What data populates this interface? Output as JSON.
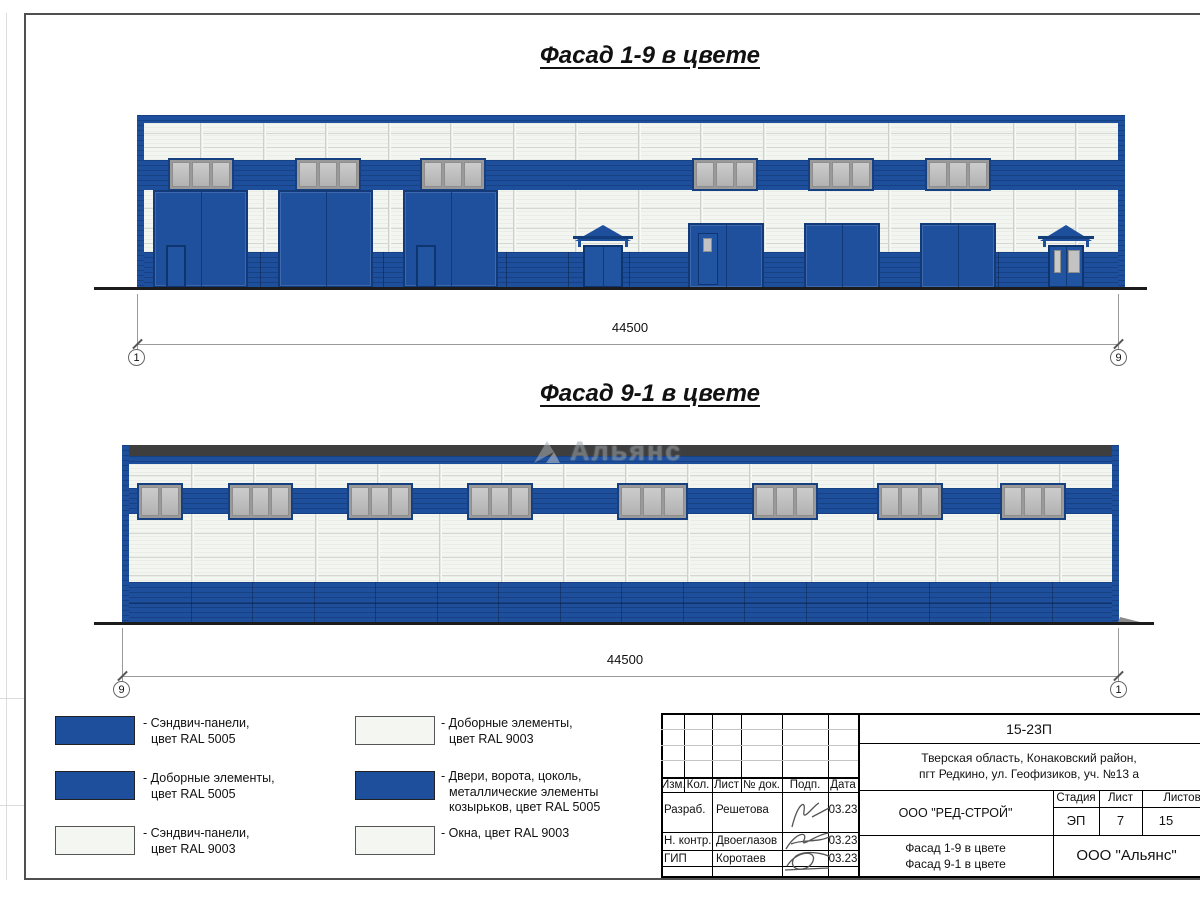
{
  "titles": {
    "facade19": "Фасад 1-9 в цвете",
    "facade91": "Фасад 9-1 в цвете"
  },
  "watermark": "Альянс",
  "dimensions": {
    "facade19": {
      "value": "44500",
      "left_axis": "1",
      "right_axis": "9"
    },
    "facade91": {
      "value": "44500",
      "left_axis": "9",
      "right_axis": "1"
    }
  },
  "colors": {
    "ral5005_blue": "#1d4f9c",
    "ral9003_white": "#f3f5f1",
    "window_gray": "#bfbfbf",
    "roof_dark": "#3e3e3e"
  },
  "legend": [
    {
      "swatch": "blue",
      "lines": [
        "- Сэндвич-панели,",
        "цвет RAL 5005"
      ]
    },
    {
      "swatch": "blue",
      "lines": [
        "- Доборные элементы,",
        "цвет RAL 5005"
      ]
    },
    {
      "swatch": "white",
      "lines": [
        "- Сэндвич-панели,",
        "цвет RAL 9003"
      ]
    },
    {
      "swatch": "white",
      "lines": [
        "- Доборные элементы,",
        "цвет RAL 9003"
      ]
    },
    {
      "swatch": "blue",
      "lines": [
        "- Двери, ворота, цоколь,",
        "металлические элементы",
        "козырьков, цвет RAL 5005"
      ]
    },
    {
      "swatch": "white",
      "lines": [
        "- Окна, цвет RAL 9003"
      ]
    }
  ],
  "titleblock": {
    "doc_number": "15-23П",
    "address_line1": "Тверская область, Конаковский район,",
    "address_line2": "пгт Редкино, ул. Геофизиков, уч. №13 а",
    "col_headers": {
      "izm": "Изм.",
      "kol": "Кол.",
      "list": "Лист",
      "doc": "№ док.",
      "podp": "Подп.",
      "data": "Дата"
    },
    "rows": [
      {
        "role": "Разраб.",
        "name": "Решетова",
        "date": "03.23"
      },
      {
        "role": "Н. контр.",
        "name": "Двоеглазов",
        "date": "03.23"
      },
      {
        "role": "ГИП",
        "name": "Коротаев",
        "date": "03.23"
      }
    ],
    "company": "ООО \"РЕД-СТРОЙ\"",
    "stage_label": "Стадия",
    "sheet_label": "Лист",
    "sheets_label": "Листов",
    "stage": "ЭП",
    "sheet": "7",
    "sheets": "15",
    "subtitle_line1": "Фасад 1-9 в цвете",
    "subtitle_line2": "Фасад 9-1 в цвете",
    "org": "ООО \"Альянс\""
  },
  "facade19_graphic": {
    "frame": {
      "x": 137,
      "y": 115,
      "w": 988,
      "h": 173
    },
    "edge": 7,
    "topband": 8,
    "stripe": {
      "y": 45,
      "h": 30
    },
    "windows": {
      "y": 43,
      "h": 33,
      "panes": 3,
      "list": [
        {
          "x": 31,
          "w": 66
        },
        {
          "x": 158,
          "w": 66
        },
        {
          "x": 283,
          "w": 66
        },
        {
          "x": 555,
          "w": 66
        },
        {
          "x": 671,
          "w": 66
        },
        {
          "x": 788,
          "w": 66
        }
      ]
    },
    "plinth": {
      "y": 137,
      "h": 36
    },
    "mullions": {
      "start": 63,
      "step": 62.5,
      "count": 15,
      "top": 8,
      "bottom": 137
    },
    "hlines": [
      18,
      32,
      93,
      113,
      128
    ],
    "gates_large": {
      "y": 75,
      "h": 98,
      "w": 95,
      "list": [
        {
          "x": 16,
          "door": 1
        },
        {
          "x": 141,
          "door": 0
        },
        {
          "x": 266,
          "door": 1
        }
      ]
    },
    "gates_medium": {
      "y": 108,
      "h": 66,
      "w": 76,
      "list": [
        {
          "x": 551,
          "pd": 1
        },
        {
          "x": 667,
          "pd": 0
        },
        {
          "x": 783,
          "pd": 0
        }
      ]
    },
    "entrances": [
      {
        "x": 438,
        "w": 56,
        "glass": 0
      },
      {
        "x": 903,
        "w": 52,
        "glass": 1
      }
    ],
    "ground": {
      "x1": -43,
      "x2": 1010,
      "y": 172
    }
  },
  "facade91_graphic": {
    "frame": {
      "x": 122,
      "y": 445,
      "w": 997,
      "h": 178
    },
    "edge": 7,
    "darkband": {
      "y": 0,
      "h": 11
    },
    "blueband": {
      "y": 11,
      "h": 8
    },
    "stripe": {
      "y": 43,
      "h": 26
    },
    "windows": {
      "y": 38,
      "h": 37,
      "panes": 3,
      "list": [
        {
          "x": 15,
          "w": 46,
          "panes": 2
        },
        {
          "x": 106,
          "w": 65
        },
        {
          "x": 225,
          "w": 66
        },
        {
          "x": 345,
          "w": 66
        },
        {
          "x": 495,
          "w": 71
        },
        {
          "x": 630,
          "w": 66
        },
        {
          "x": 755,
          "w": 66
        },
        {
          "x": 878,
          "w": 66
        }
      ]
    },
    "plinth": {
      "y": 137,
      "h": 41,
      "divline": 21
    },
    "mullions": {
      "start": 69,
      "step": 62,
      "count": 15,
      "top": 19,
      "bottom": 137
    },
    "hlines": [
      30,
      88,
      112,
      130
    ],
    "ground": {
      "x1": -28,
      "x2": 1032,
      "y": 177
    }
  }
}
